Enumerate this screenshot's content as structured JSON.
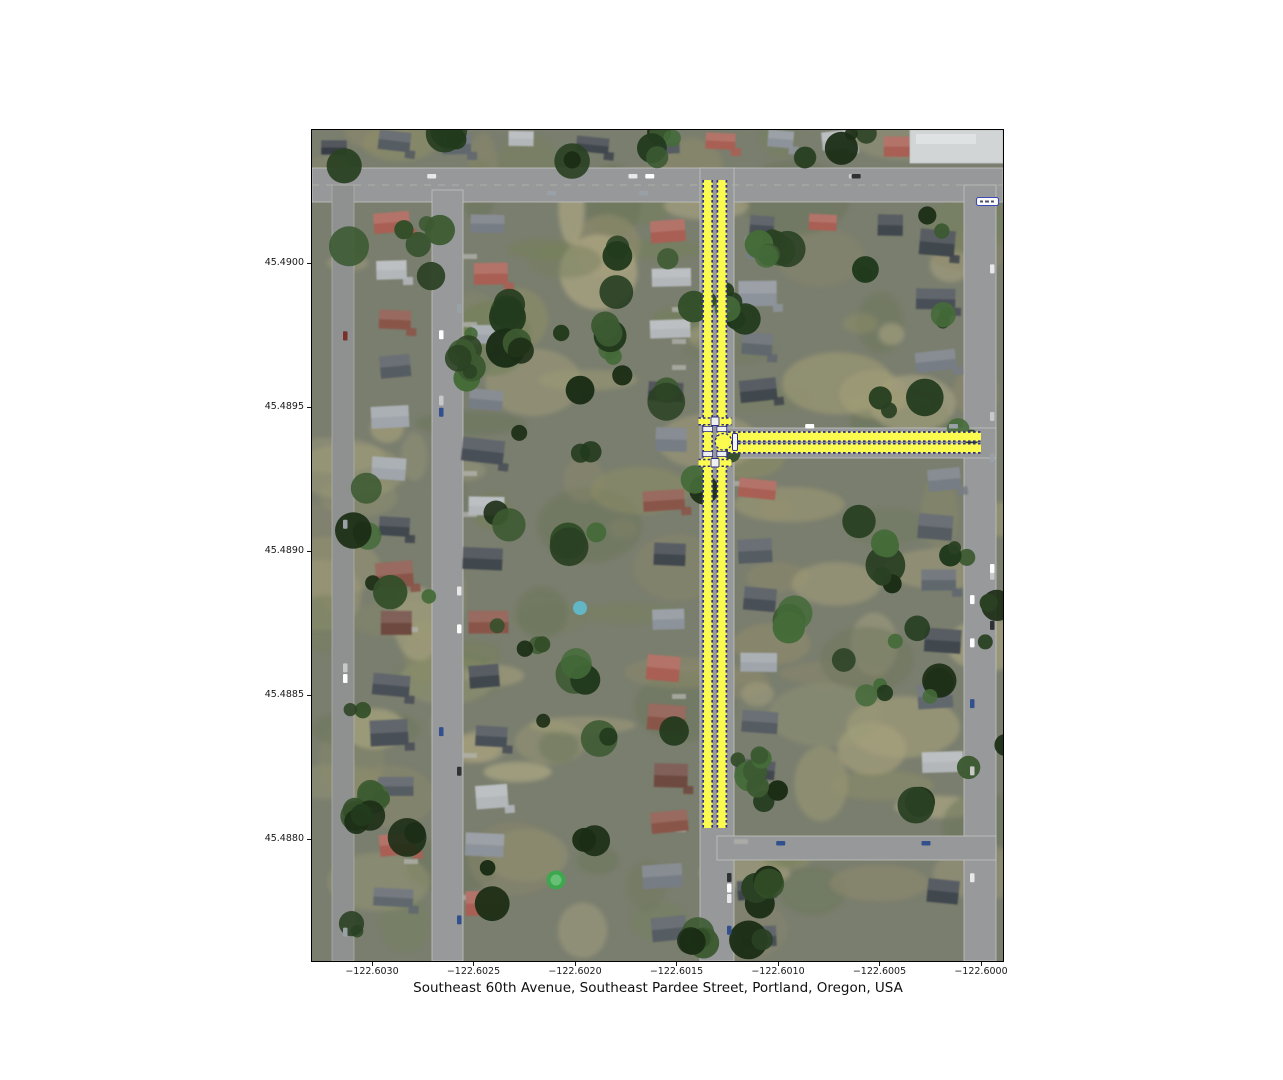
{
  "figure": {
    "xlabel": "Southeast 60th Avenue, Southeast Pardee Street, Portland, Oregon, USA"
  },
  "axes": {
    "x_ticks": [
      "−122.6030",
      "−122.6025",
      "−122.6020",
      "−122.6015",
      "−122.6010",
      "−122.6005",
      "−122.6000"
    ],
    "y_ticks": [
      "45.4900",
      "45.4895",
      "45.4890",
      "45.4885",
      "45.4880"
    ],
    "x_axis": "longitude",
    "y_axis": "latitude"
  },
  "map": {
    "type": "aerial-imagery-with-street-route-overlay",
    "location": "Portland, Oregon, USA",
    "highlighted_streets": [
      {
        "name": "Southeast 60th Avenue",
        "orientation": "north-south",
        "longitude": -122.6013,
        "lat_range": [
          45.488,
          45.4903
        ],
        "style": "double yellow band with navy dashed edges"
      },
      {
        "name": "Southeast Pardee Street",
        "orientation": "east-west",
        "latitude": 45.4894,
        "lon_range": [
          -122.6013,
          -122.6
        ],
        "style": "double yellow band with navy dashed edges"
      }
    ],
    "intersection": {
      "type": "T-intersection with crossing marks and node circle",
      "longitude": -122.6013,
      "latitude": 45.4894
    },
    "route_fill_color": "#fbfb4f",
    "route_edge_color": "#2e2e8a",
    "lon_range": [
      -122.6033,
      -122.5999
    ],
    "lat_range": [
      45.4877,
      45.4905
    ]
  }
}
